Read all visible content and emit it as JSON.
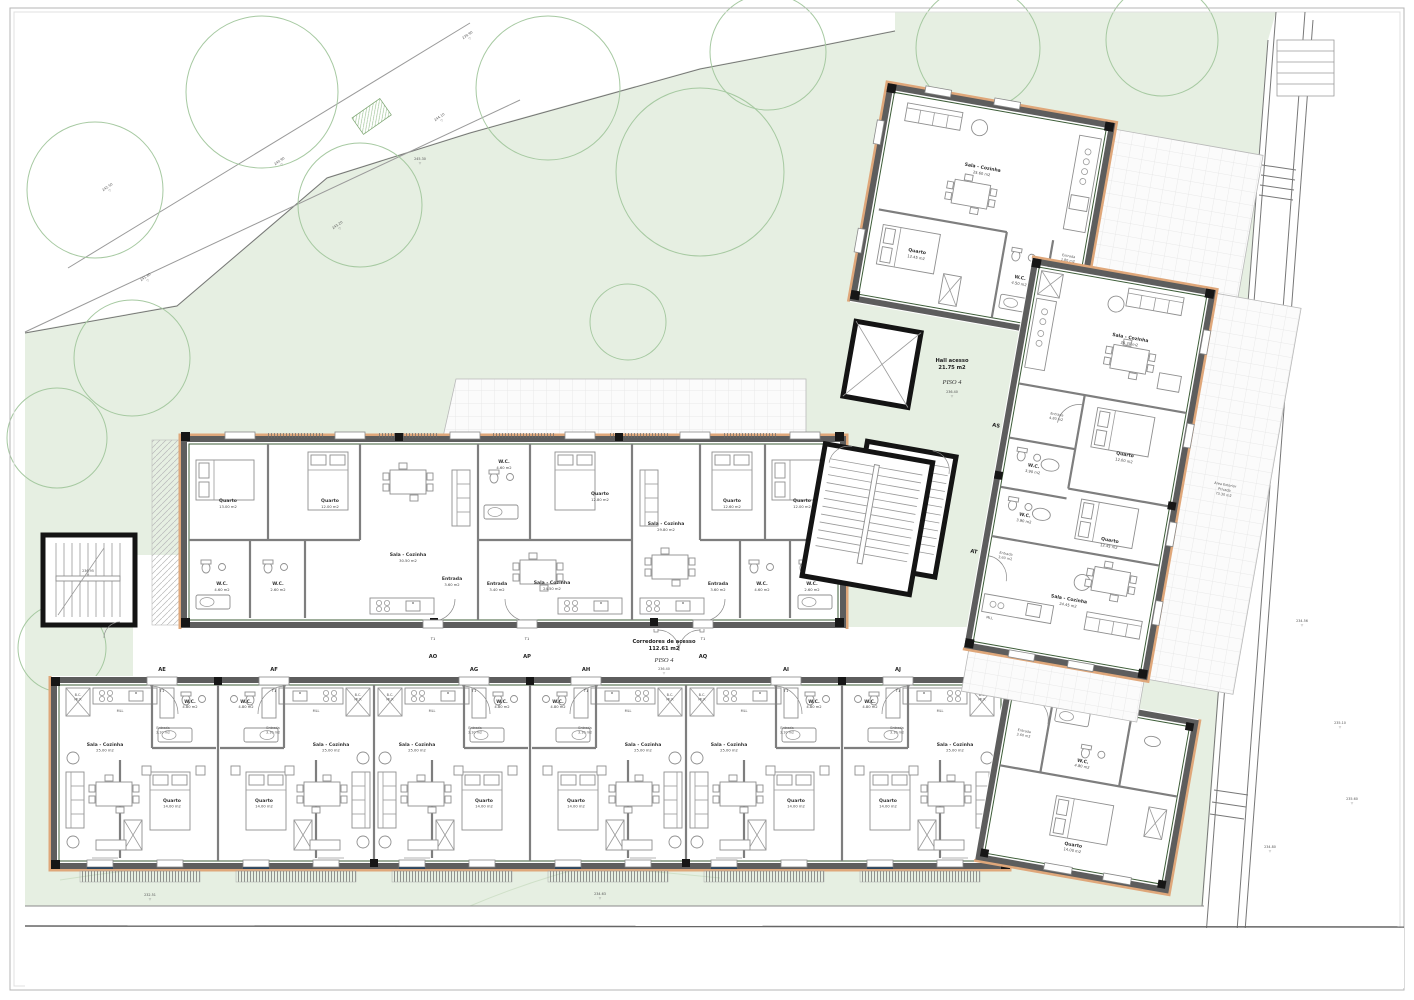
{
  "site": {
    "door_tag": "T1",
    "corridor": {
      "name": "Corredores de acesso",
      "area": "112.61 m2",
      "floor": "PISO 4",
      "level": "236.40"
    },
    "hall": {
      "name": "Hall acesso",
      "area": "21.75 m2",
      "floor": "PISO 4",
      "level": "236.40"
    },
    "exterior": {
      "line1": "Área Exterior",
      "line2": "Privada",
      "area": "73.30 m2"
    },
    "levels": {
      "stair_left": "236.95",
      "road": [
        "242.50",
        "241.80",
        "240.90",
        "243.20",
        "244.10",
        "239.90"
      ],
      "garden": [
        "232.51",
        "234.63",
        "245.30"
      ],
      "right": [
        "234.56",
        "235.10",
        "235.60",
        "234.80"
      ]
    }
  },
  "t1_rooms": {
    "sala": "Sala - Cozinha",
    "sala_area": "25.00 m2",
    "quarto": "Quarto",
    "quarto_area": "14.00 m2",
    "wc": "W.C.",
    "wc_area": "4.80 m2",
    "entrada": "Entrada",
    "entrada_area": "3.10 m2",
    "bc": "B.C.",
    "bcr": "MLR",
    "mll": "MLL"
  },
  "bottom_units": [
    {
      "code": "AE"
    },
    {
      "code": "AF"
    },
    {
      "code": "AG"
    },
    {
      "code": "AH"
    },
    {
      "code": "AI"
    },
    {
      "code": "AJ"
    },
    {
      "code": "AK",
      "entrada": "Entrada",
      "entrada_area": "3.60 m2",
      "wc": "W.C.",
      "wc_area": "4.80 m2",
      "quarto": "Quarto",
      "quarto_area": "14.00 m2"
    }
  ],
  "middle_units": [
    {
      "code": "AO",
      "q1": "Quarto",
      "q1_area": "13.00 m2",
      "q2": "Quarto",
      "q2_area": "12.00 m2",
      "sala": "Sala - Cozinha",
      "sala_area": "30.50 m2",
      "wc1": "W.C.",
      "wc1_area": "4.60 m2",
      "wc2": "W.C.",
      "wc2_area": "2.60 m2",
      "entrada": "Entrada",
      "entrada_area": "3.60 m2"
    },
    {
      "code": "AP",
      "quarto": "Quarto",
      "quarto_area": "12.80 m2",
      "sala": "Sala - Cozinha",
      "sala_area": "24.50 m2",
      "wc": "W.C.",
      "wc_area": "4.60 m2",
      "entrada": "Entrada",
      "entrada_area": "3.40 m2"
    },
    {
      "code": "AQ",
      "q1": "Quarto",
      "q1_area": "12.60 m2",
      "q2": "Quarto",
      "q2_area": "12.00 m2",
      "sala": "Sala - Cozinha",
      "sala_area": "29.80 m2",
      "wc1": "W.C.",
      "wc1_area": "4.60 m2",
      "wc2": "W.C.",
      "wc2_area": "2.60 m2",
      "entrada": "Entrada",
      "entrada_area": "3.60 m2"
    }
  ],
  "top_units": [
    {
      "code": "AR",
      "sala": "Sala - Cozinha",
      "sala_area": "25.60 m2",
      "quarto": "Quarto",
      "quarto_area": "12.45 m2",
      "wc": "W.C.",
      "wc_area": "4.50 m2",
      "entrada": "Entrada",
      "entrada_area": "1.80 m2"
    },
    {
      "code": "AS",
      "sala": "Sala - Cozinha",
      "sala_area": "24.30 m2",
      "quarto": "Quarto",
      "quarto_area": "12.00 m2",
      "wc": "W.C.",
      "wc_area": "3.90 m2",
      "entrada": "Entrada",
      "entrada_area": "4.80 m2",
      "bc": "B.C.",
      "bcr": "MLR"
    },
    {
      "code": "AT",
      "sala": "Sala - Cozinha",
      "sala_area": "24.45 m2",
      "quarto": "Quarto",
      "quarto_area": "12.45 m2",
      "wc": "W.C.",
      "wc_area": "3.90 m2",
      "entrada": "Entrada",
      "entrada_area": "3.60 m2",
      "mll": "MLL"
    }
  ]
}
